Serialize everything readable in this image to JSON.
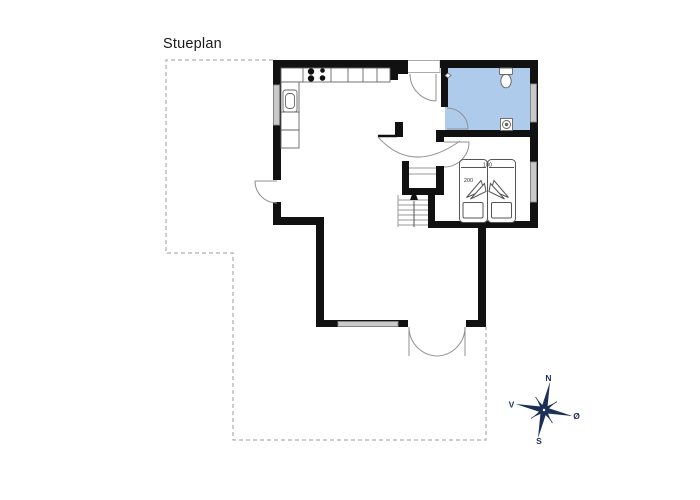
{
  "title": "Stueplan",
  "bedroom": {
    "bed_width_label": "180",
    "bed_length_label": "200"
  },
  "compass": {
    "north": "N",
    "south": "S",
    "west": "V",
    "east": "Ø"
  },
  "colors": {
    "wall": "#111111",
    "bathroom_fill": "#AECBEC",
    "window_fill": "#C9C9C9",
    "window_stroke": "#888888",
    "fixture_stroke": "#666666",
    "door_stroke": "#909090",
    "stair_stroke": "#999999",
    "dash_stroke": "#9B9B9B",
    "recess_stroke": "#AAAAAA",
    "bed_stroke": "#555555",
    "label_text": "#333333",
    "compass": "#1B2F57",
    "title_text": "#1A1A1A"
  }
}
